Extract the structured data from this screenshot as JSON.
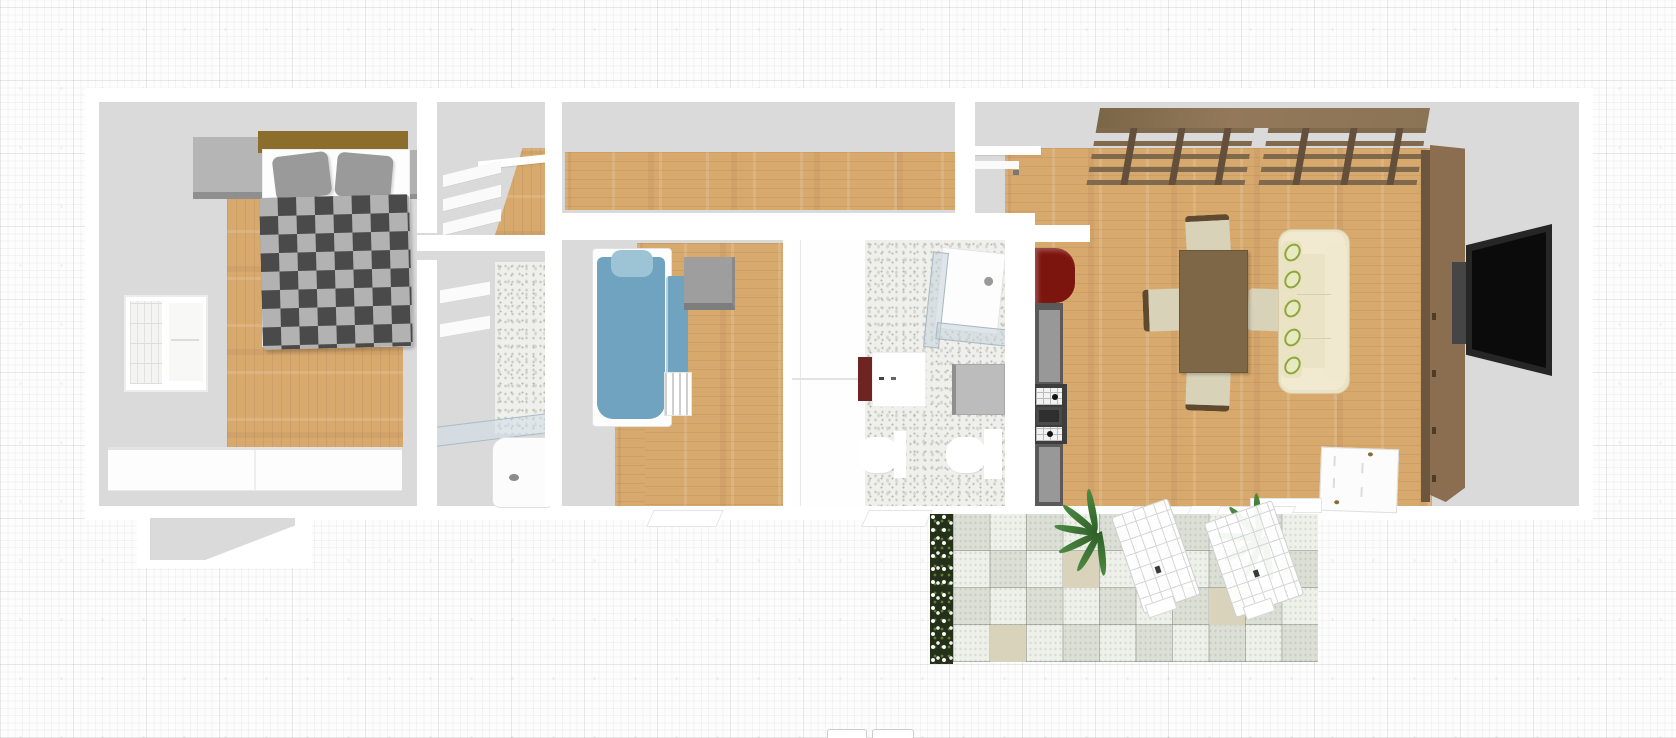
{
  "app": {
    "name": "floor-plan-viewer",
    "view": "3d-overhead-apartment-floor-plan",
    "visible_text": "none"
  },
  "palette": {
    "wall": "#ffffff",
    "floorGray": "#dadada",
    "wood": "#d8a96d",
    "terrazzo": "#efefec",
    "duvetDark": "#4a4a4a",
    "duvetLight": "#b2b2b2",
    "headboardBrown": "#8b6d2c",
    "bedBlue": "#6fa3bf",
    "pillowBlue": "#9cc4d4",
    "accentRed": "#7d150f",
    "counterGray": "#5a5a5a",
    "loftBrown": "#8b7355",
    "loftBeam": "#64503a",
    "cabinetBrown": "#8a6e4f",
    "cabinetEdge": "#6d563e",
    "tvBlack": "#0b0b0b",
    "sofaCream": "#ebe3c6",
    "leafGreen": "#8fa63c",
    "chairCream": "#d8d2b8",
    "chairFrame": "#5f4a30",
    "tableBrown": "#7d6747",
    "tileLight": "#eef0ea",
    "tileGray": "#dcdfd6",
    "tileBeige": "#d8d3ba",
    "planterGreen": "#243018",
    "palmGreen": "#4e8a42"
  },
  "scene": {
    "rooms": [
      {
        "id": "master-bedroom",
        "furniture": [
          "double-bed",
          "checkered-duvet",
          "gray-pillows",
          "nightstand-left",
          "nightstand-right",
          "window",
          "dresser-wardrobe"
        ]
      },
      {
        "id": "walk-in-closet",
        "furniture": [
          "shelving-unit",
          "counter-shelf"
        ]
      },
      {
        "id": "bathroom-1",
        "furniture": [
          "wall-shelves",
          "shower-area",
          "glass-shelf",
          "bathtub"
        ]
      },
      {
        "id": "hallway",
        "furniture": [
          "entry-bench"
        ]
      },
      {
        "id": "kids-bedroom",
        "furniture": [
          "single-bed-blue",
          "blue-pillow",
          "cube-nightstand",
          "radiator"
        ]
      },
      {
        "id": "hall-closet",
        "furniture": [
          "built-in-wardrobe"
        ]
      },
      {
        "id": "bathroom-2",
        "furniture": [
          "corner-shower",
          "sink-vanity",
          "washing-machine",
          "toilet",
          "bidet"
        ]
      },
      {
        "id": "kitchen",
        "furniture": [
          "red-cabinet",
          "kitchen-counter",
          "cooktop-stove"
        ]
      },
      {
        "id": "living-dining-room",
        "furniture": [
          "loft-beam-structure",
          "dining-table",
          "dining-chair-top",
          "dining-chair-bottom",
          "dining-chair-left",
          "dining-chair-right",
          "sofa",
          "tv-wall-cabinet",
          "tv",
          "open-door"
        ]
      },
      {
        "id": "patio",
        "furniture": [
          "flower-planter",
          "checkered-tiles",
          "palm-plant-1",
          "palm-plant-2",
          "lattice-lounger-1",
          "lattice-lounger-2"
        ]
      }
    ]
  },
  "toolbar": {
    "bottom_button_count": 2,
    "bottom_button_labels": [
      "",
      ""
    ]
  }
}
